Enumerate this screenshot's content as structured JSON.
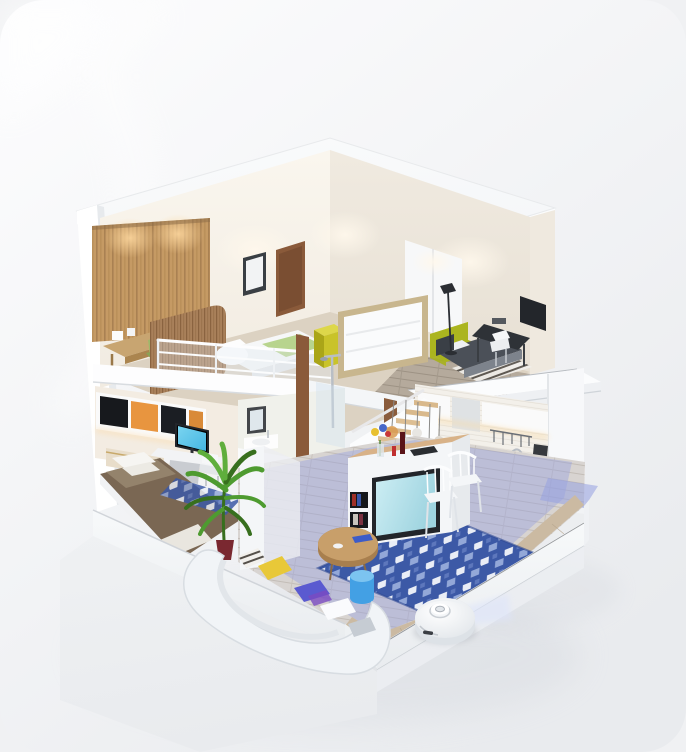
{
  "scene": {
    "type": "3d-isometric-apartment-cutaway",
    "rooms": [
      "loft-bedroom",
      "upper-bedroom",
      "lower-bedroom",
      "bathroom",
      "kitchen",
      "living-room"
    ],
    "objects": [
      "roof-slab",
      "cut-left-wall",
      "wood-slat-wall",
      "loft-desk",
      "loft-bed",
      "glass-railing",
      "picture-frame",
      "wood-door",
      "headboard-screen-panel",
      "yellow-cube-table",
      "lime-sofa",
      "charcoal-bed",
      "floor-lamp",
      "black-desk",
      "white-chair",
      "striped-rug",
      "white-wardrobe",
      "wall-cabinets",
      "computer-monitor",
      "single-bed-brown-duvet",
      "small-blue-rug",
      "palm-plant",
      "mirror",
      "sink",
      "shower",
      "staircase",
      "pendant-lamps",
      "kitchen-cabinets",
      "cooktop",
      "kitchen-sink",
      "knife-block",
      "kitchen-island",
      "flower-vase",
      "television",
      "bookshelf-cubbies",
      "dining-chairs",
      "blue-geometric-rug",
      "round-coffee-table",
      "blue-stool",
      "curved-white-sofa",
      "throw-pillows",
      "robot-vacuum",
      "lidar-beam",
      "cleaned-area-overlay",
      "floor-slab-steps"
    ]
  },
  "palette": {
    "page_bg": "#f0f1f3",
    "card_top": "#fdfdfe",
    "card_bottom": "#e9ebee",
    "roof": "#f4f6f8",
    "white": "#ffffff",
    "slab_face": "#f3f5f7",
    "cream_wall": "#f1ebe1",
    "beige_wall": "#e7e0d4",
    "tile_wall": "#f3f0ea",
    "wood_slat": "#c59a64",
    "wood_slat_dark": "#9a7448",
    "wood_screen": "#a9805a",
    "wood_desk": "#c8a571",
    "wood_table": "#c89f6a",
    "floor_loft": "#dcd2c2",
    "floor_gray": "#b5aa9c",
    "floor_living": "#d8d4d1",
    "floor_border": "#cbbaa2",
    "lime": "#bcc62e",
    "yellow_cube": "#c9c32a",
    "green_bedding": "#b8d48e",
    "green_chair": "#9fb86a",
    "charcoal_bed": "#4b5058",
    "duvet_brown": "#7a6753",
    "rug_blue": "#3c59a6",
    "rug_light": "#e9edf6",
    "small_rug": "#5565b8",
    "overlay_lavender": "#96a0e0",
    "lidar_beam": "#dde4fa",
    "robot_body": "#ffffff",
    "tv_screen": "#cdeef4",
    "monitor_screen": "#45b6e2",
    "stool_blue": "#43a0e4",
    "stool_top": "#7cc4f0",
    "plant_green": "#4e9b30",
    "plant_dark": "#376f1e",
    "door_brown": "#8a5a3a",
    "frame_tan": "#c8b68e",
    "accent_red": "#c03030",
    "pillow_yellow": "#e8c838",
    "pillow_violet": "#5a5ad0",
    "dark": "#24272c",
    "chrome": "#b9bec5",
    "glow_warm": "#ffd9a0"
  }
}
